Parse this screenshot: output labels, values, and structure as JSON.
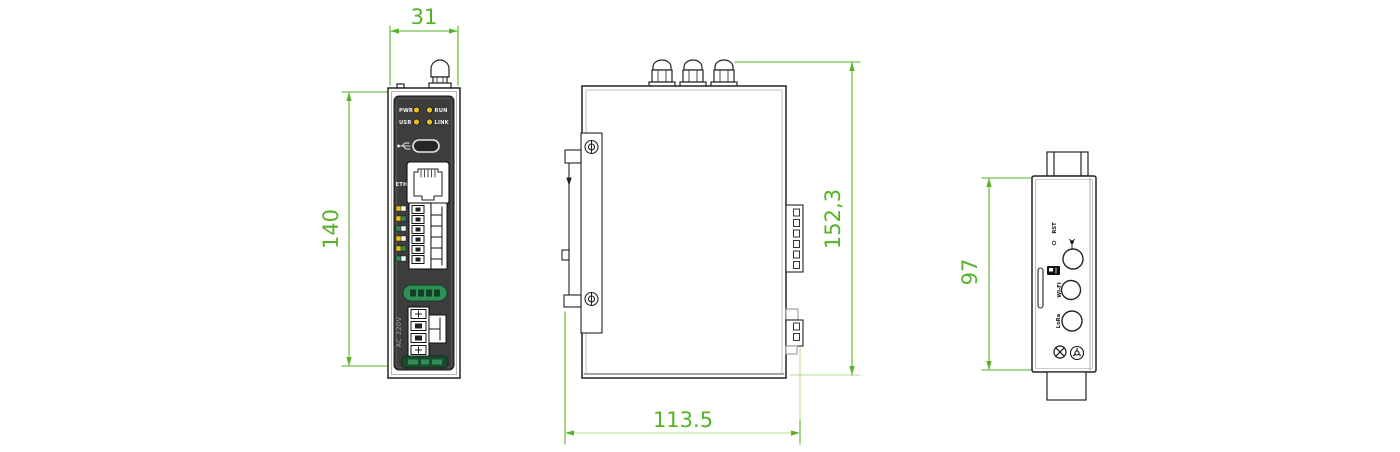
{
  "colors": {
    "dimension_green": "#56b226",
    "dimension_light_green": "#b9dd8e",
    "line_dark": "#222222",
    "panel_dark": "#3d3d3d",
    "led_yellow": "#e7c019",
    "label_pill_green": "#2f8f55",
    "bottom_bar_green": "#1c4a2e"
  },
  "dims": {
    "front_width": "31",
    "front_height": "140",
    "side_height": "152,3",
    "side_width": "113.5",
    "top_height": "97"
  },
  "front_view": {
    "leds": {
      "pwr": "PWR",
      "run": "RUN",
      "usr": "USR",
      "link": "LINK"
    },
    "eth": "ETH",
    "power": "AC 220V"
  },
  "top_view": {
    "rst": "RST",
    "wifi": "WI-FI",
    "lora": "LoRa"
  }
}
